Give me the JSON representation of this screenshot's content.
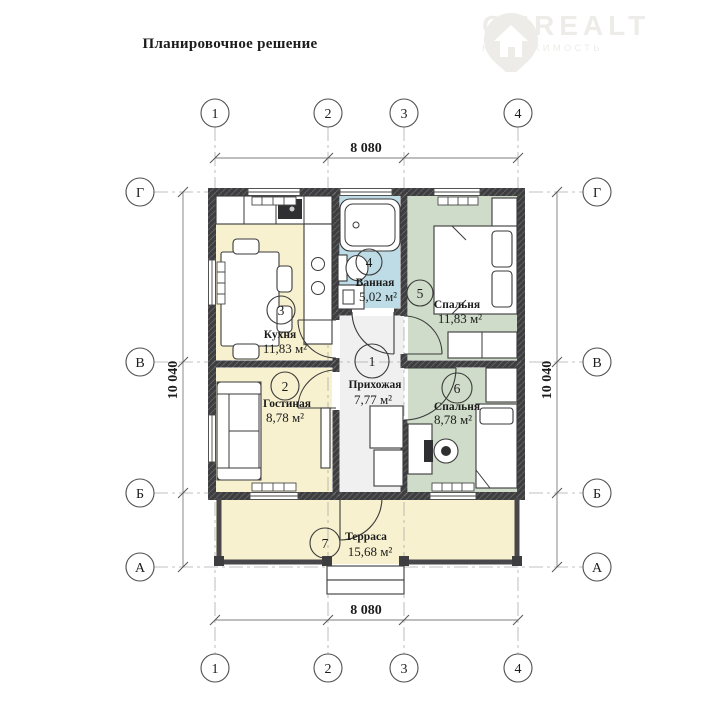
{
  "title": "Планировочное решение",
  "logo": {
    "brand": "ONREALT",
    "subtitle": "НЕДВИЖИМОСТЬ"
  },
  "axes": {
    "columns": [
      "1",
      "2",
      "3",
      "4"
    ],
    "rows": [
      "Г",
      "В",
      "Б",
      "А"
    ]
  },
  "dimensions": {
    "width": "8 080",
    "height": "10 040"
  },
  "rooms": [
    {
      "number": "1",
      "name": "Прихожая",
      "area": "7,77 м²",
      "color": "#f0f0f0"
    },
    {
      "number": "2",
      "name": "Гостиная",
      "area": "8,78 м²",
      "color": "#f7f1cf"
    },
    {
      "number": "3",
      "name": "Кухня",
      "area": "11,83 м²",
      "color": "#f7f1cf"
    },
    {
      "number": "4",
      "name": "Ванная",
      "area": "5,02 м²",
      "color": "#bedce6"
    },
    {
      "number": "5",
      "name": "Спальня",
      "area": "11,83 м²",
      "color": "#cfdcc9"
    },
    {
      "number": "6",
      "name": "Спальня",
      "area": "8,78 м²",
      "color": "#cfdcc9"
    },
    {
      "number": "7",
      "name": "Терраса",
      "area": "15,68 м²",
      "color": "#f7f1cf"
    }
  ],
  "colors": {
    "wall": "#3e3e40",
    "axis_line": "#9a9a9a",
    "text": "#1c1c1c"
  }
}
